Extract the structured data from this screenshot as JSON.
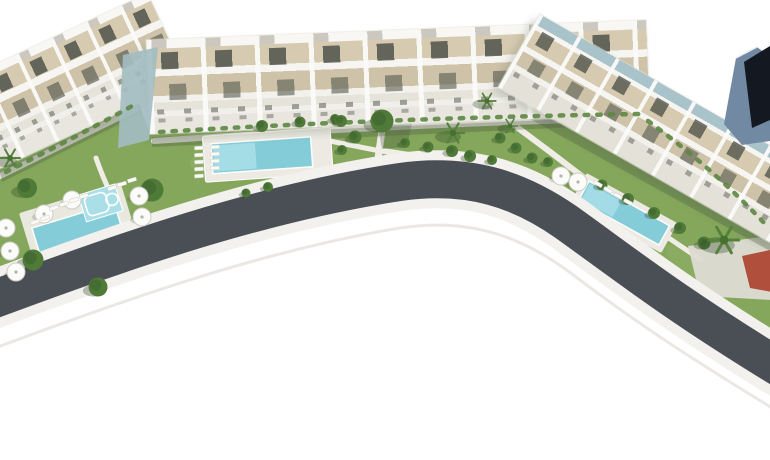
{
  "meta": {
    "description": "Aerial 3D architectural rendering of a residential complex: three white terraced apartment blocks with tan roof terraces, landscaped gardens with palm trees, sun umbrellas and loungers, three turquoise swimming pools, a dark corner tower and a curved asphalt road sweeping across the bottom"
  },
  "colors": {
    "background": "#ffffff",
    "lawn": "#85a75c",
    "lawn_light": "#9cbd72",
    "path": "#f0ede6",
    "sidewalk": "#f3f1ed",
    "road": "#4a4f56",
    "road_line": "#e9e6e1",
    "deck": "#eceae2",
    "pool_water": "#85ccd9",
    "pool_water_light": "#aadfe8",
    "building_white": "#f6f5f1",
    "terrace_tan": "#d6cab1",
    "terrace_tan_dark": "#cec2a8",
    "window_dark": "#585c54",
    "roof_teal": "#a9c3ca",
    "teal_wall": "#a2bcc2",
    "tower_dark": "#141921",
    "tower_blue": "#7189a2",
    "tree_green": "#4f7a38",
    "palm_green": "#55813c",
    "hedge_green": "#5d8743",
    "umbrella_white": "#fbfbf9",
    "court_red": "#b0503c",
    "car_red": "#c0392b",
    "plaza": "#dedbd3"
  },
  "scene": {
    "buildings": [
      {
        "id": "west-block",
        "label": "west terraced block"
      },
      {
        "id": "central-block",
        "label": "central terraced block"
      },
      {
        "id": "east-block",
        "label": "east terraced block"
      },
      {
        "id": "corner-tower",
        "label": "dark corner tower"
      }
    ],
    "pools": [
      "west-pool",
      "west-kids-pool",
      "central-pool",
      "east-pool"
    ],
    "road": "curved-access-road",
    "features": [
      "gardens",
      "palm-trees",
      "sun-umbrellas",
      "sun-loungers",
      "red-sports-court"
    ]
  }
}
